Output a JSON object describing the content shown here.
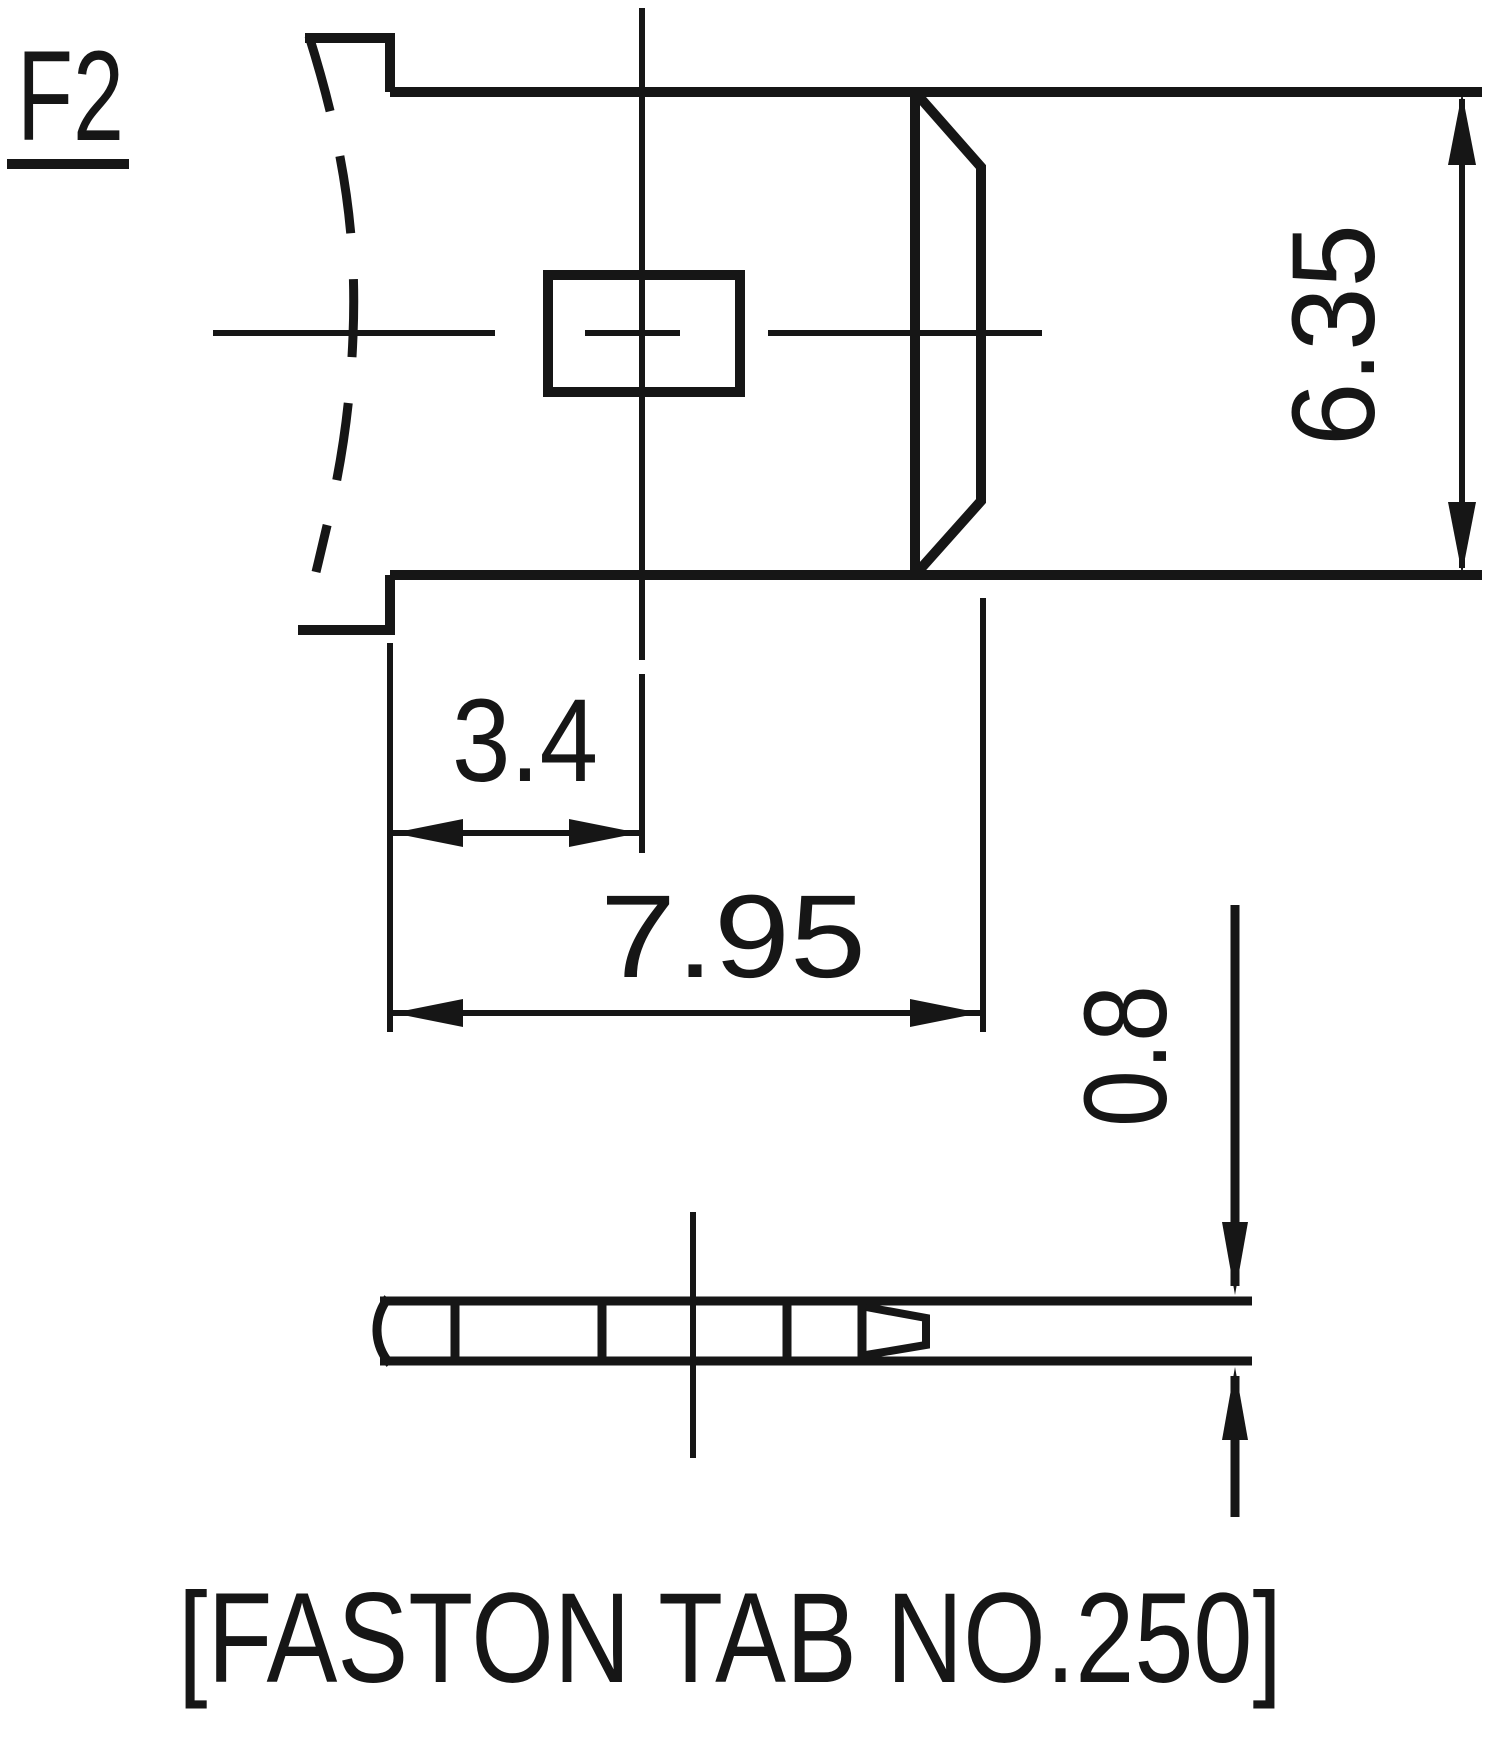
{
  "page": {
    "background_color": "#ffffff",
    "line_color": "#161616"
  },
  "drawing": {
    "view_label": "F2",
    "caption": "[FASTON TAB NO.250]",
    "views": {
      "top_view": "terminal-tab-face-view",
      "side_view": "terminal-tab-edge-view"
    },
    "dimensions": {
      "tab_width_mm": "6.35",
      "hole_center_offset_mm": "3.4",
      "tab_length_mm": "7.95",
      "thickness_mm": "0.8"
    }
  }
}
